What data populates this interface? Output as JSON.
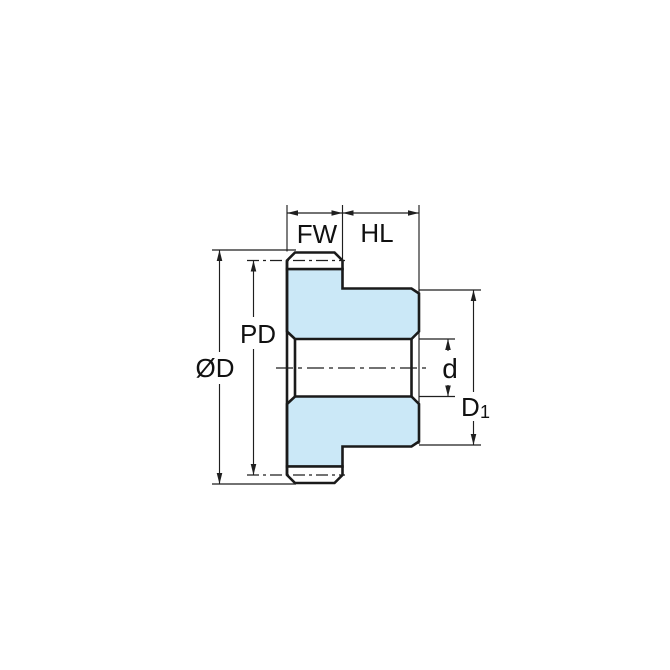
{
  "diagram": {
    "type": "technical-dimension-drawing",
    "subject": "Spur gear with hub, side cross-section view",
    "background_color": "#ffffff",
    "colors": {
      "body_fill": "#cbe8f7",
      "tooth_fill": "#ffffff",
      "outline": "#1a1a1a",
      "dimension_lines": "#1f1f1f",
      "text": "#111111"
    },
    "dimensions": {
      "face_width": {
        "label": "FW",
        "meaning": "face width of toothed rim"
      },
      "hub_length": {
        "label": "HL",
        "meaning": "hub length"
      },
      "outside_diameter": {
        "label": "ØD",
        "meaning": "outside diameter over teeth"
      },
      "pitch_diameter": {
        "label": "PD",
        "meaning": "pitch diameter"
      },
      "bore_diameter": {
        "label": "d",
        "meaning": "bore diameter"
      },
      "hub_diameter": {
        "label": "D",
        "sub": "1",
        "meaning": "hub diameter"
      }
    }
  }
}
